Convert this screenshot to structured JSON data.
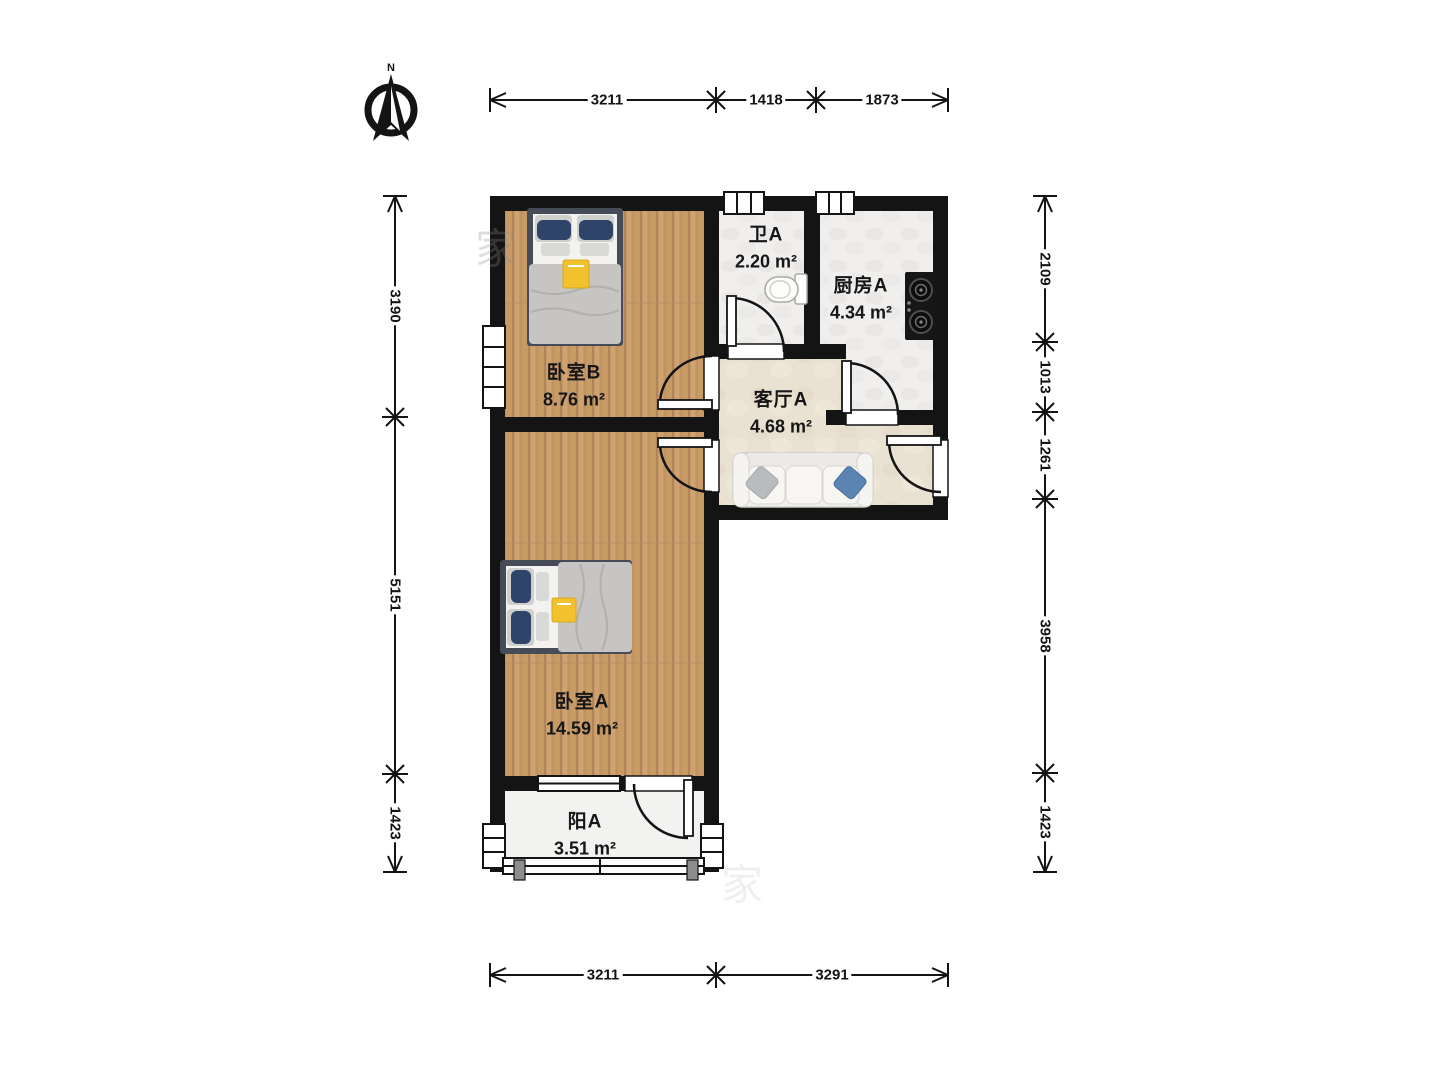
{
  "compass": {
    "label": "N"
  },
  "watermark": "家",
  "rooms": [
    {
      "id": "bedroom-b",
      "name": "卧室B",
      "area": "8.76 m²"
    },
    {
      "id": "bath-a",
      "name": "卫A",
      "area": "2.20 m²"
    },
    {
      "id": "kitchen-a",
      "name": "厨房A",
      "area": "4.34 m²"
    },
    {
      "id": "living-a",
      "name": "客厅A",
      "area": "4.68 m²"
    },
    {
      "id": "bedroom-a",
      "name": "卧室A",
      "area": "14.59 m²"
    },
    {
      "id": "balcony-a",
      "name": "阳A",
      "area": "3.51 m²"
    }
  ],
  "dimensions": {
    "top": [
      "3211",
      "1418",
      "1873"
    ],
    "bottom": [
      "3211",
      "3291"
    ],
    "left": [
      "3190",
      "5151",
      "1423"
    ],
    "right": [
      "2109",
      "1013",
      "1261",
      "3958",
      "1423"
    ]
  },
  "colors": {
    "wall": "#141414",
    "wood_floor": "#c89a66",
    "tile_floor": "#f0efed",
    "hall_floor": "#e9e1d2",
    "balcony_floor": "#f2f2f0",
    "pillow_navy": "#2e4468",
    "pillow_blue": "#5b85b0",
    "blanket_gray": "#c6c5c3",
    "accent_yellow": "#f2c12e"
  }
}
